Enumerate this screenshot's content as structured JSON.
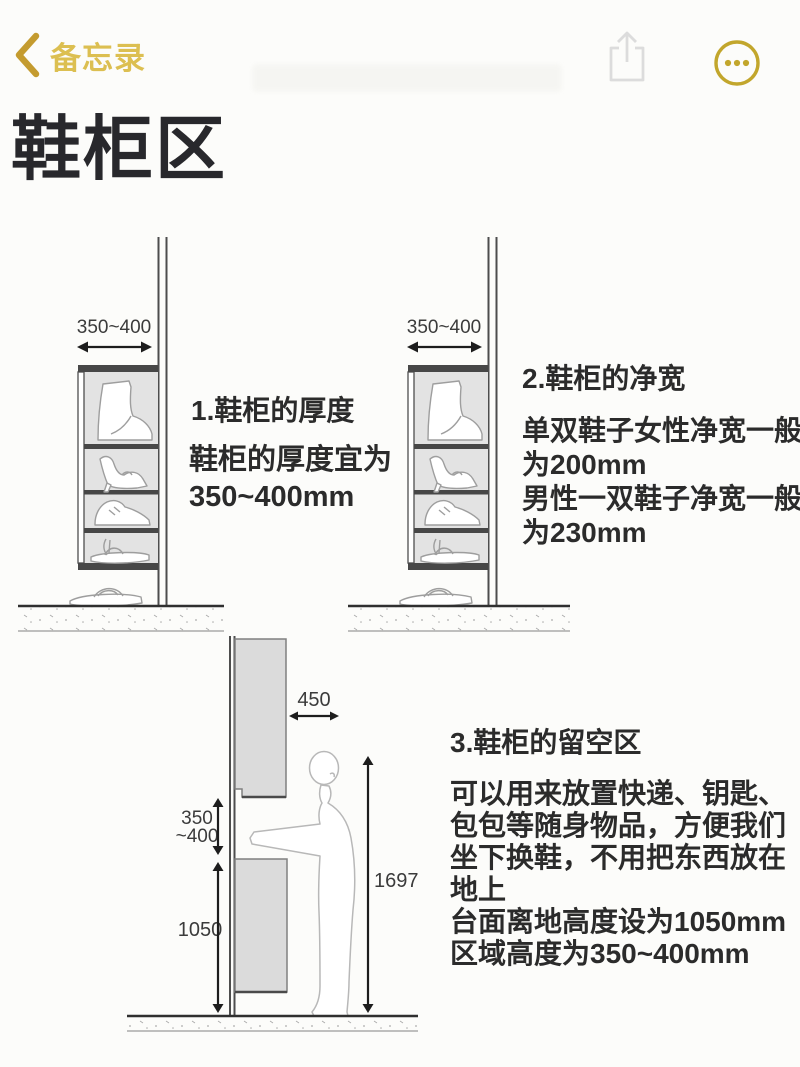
{
  "nav": {
    "back_label": "备忘录",
    "icons": {
      "back": "chevron-left",
      "share": "share-up-arrow",
      "more": "ellipsis-in-circle"
    }
  },
  "colors": {
    "accent_gold": "#C49B2F",
    "label_gold": "#DCBF51",
    "text_dark": "#2B2B2B",
    "cabinet_fill": "#E3E3E3",
    "block_fill": "#DBDBDB"
  },
  "note": {
    "title": "鞋柜区"
  },
  "sections": [
    {
      "heading": "1.鞋柜的厚度",
      "body": [
        "鞋柜的厚度宜为",
        "350~400mm"
      ],
      "dim_width": "350~400"
    },
    {
      "heading": "2.鞋柜的净宽",
      "body": [
        "单双鞋子女性净宽一般",
        "为200mm",
        "男性一双鞋子净宽一般",
        "为230mm"
      ],
      "dim_width": "350~400"
    },
    {
      "heading": "3.鞋柜的留空区",
      "body": [
        "可以用来放置快递、钥匙、",
        "包包等随身物品，方便我们",
        "坐下换鞋，不用把东西放在",
        "地上",
        "台面离地高度设为1050mm",
        "区域高度为350~400mm"
      ],
      "dims": {
        "depth": "450",
        "gap_line1": "350",
        "gap_line2": "~400",
        "counter_height": "1050",
        "person_height": "1697"
      }
    }
  ]
}
